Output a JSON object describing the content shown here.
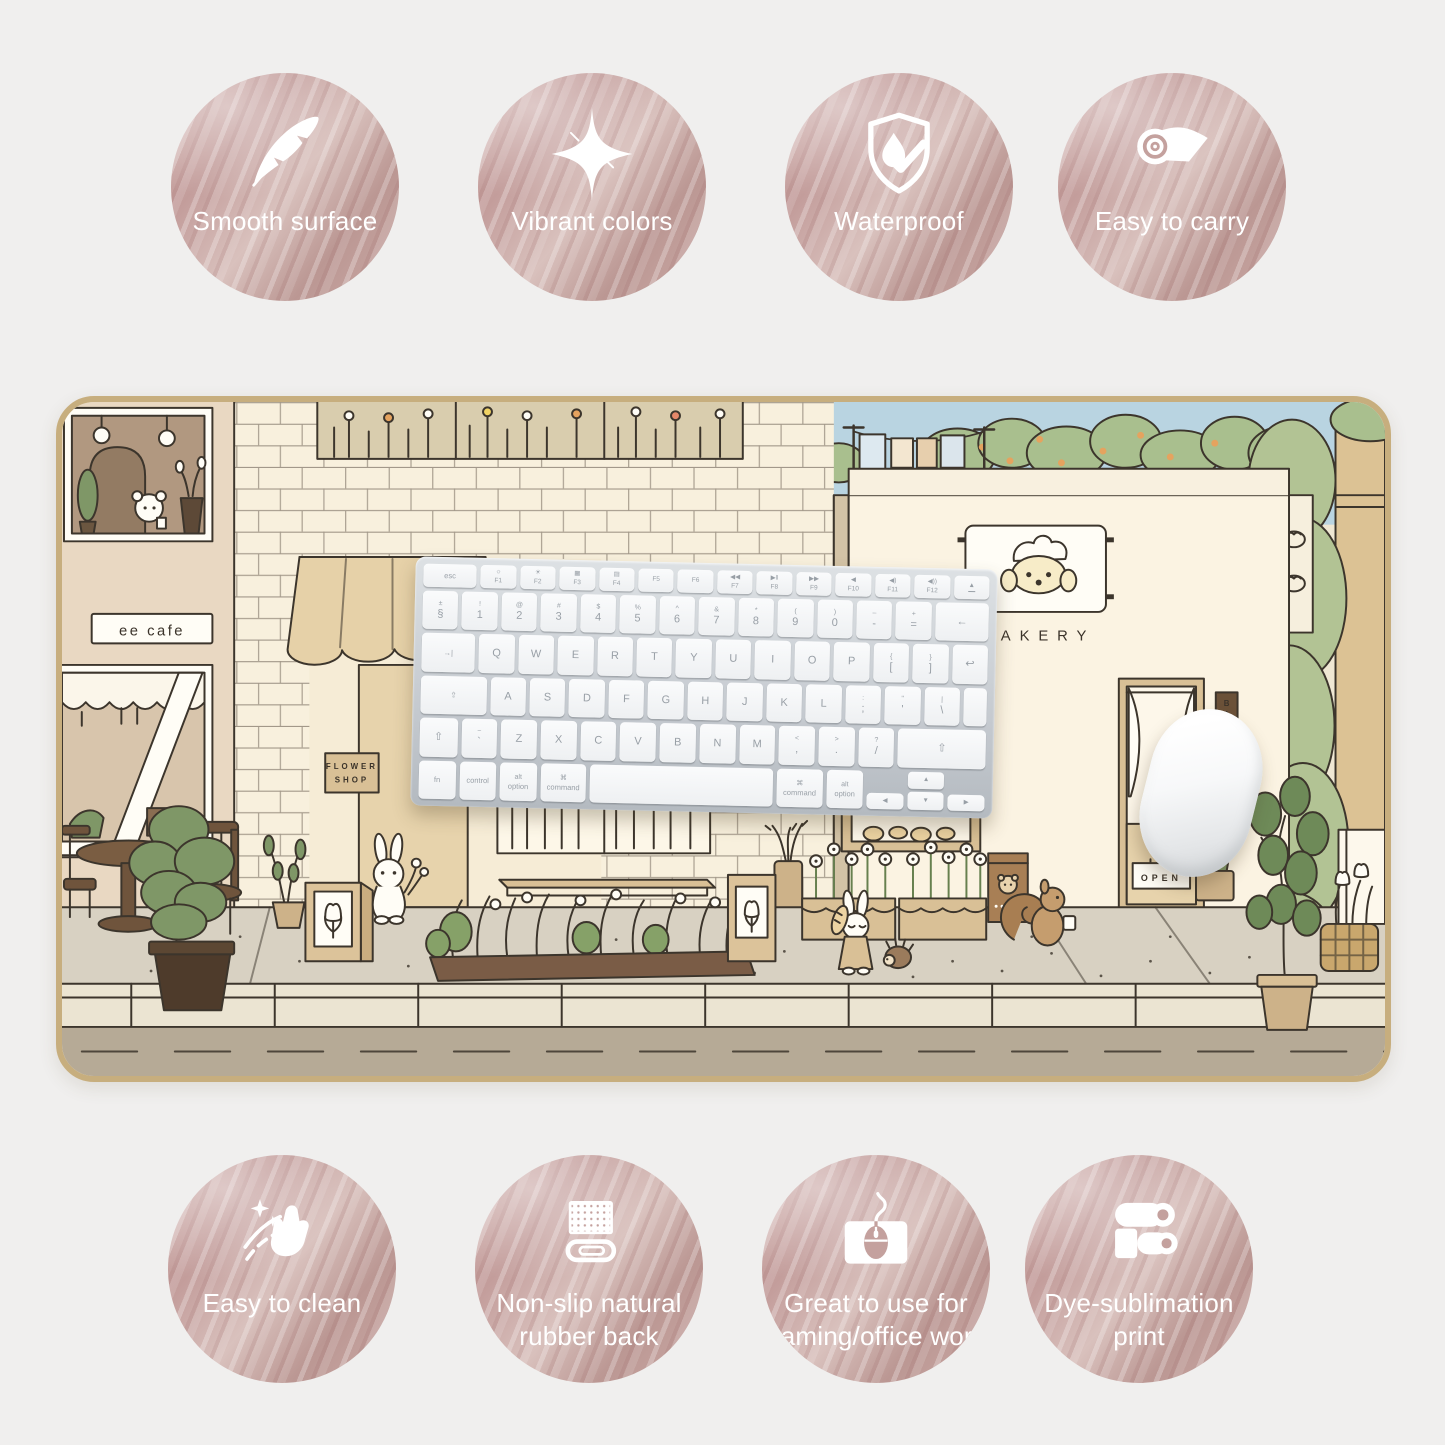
{
  "page": {
    "background": "#f0efee",
    "badge_pink": "#c4a19e",
    "badge_text_color": "#ffffff"
  },
  "badges": {
    "top": [
      {
        "label": "Smooth surface",
        "icon": "feather-icon"
      },
      {
        "label": "Vibrant colors",
        "icon": "sparkle-icon"
      },
      {
        "label": "Waterproof",
        "icon": "waterproof-shield-icon"
      },
      {
        "label": "Easy to carry",
        "icon": "rolled-mat-icon"
      }
    ],
    "bottom": [
      {
        "label": "Easy to clean",
        "icon": "cleaning-hand-icon"
      },
      {
        "label": "Non-slip natural\nrubber back",
        "icon": "rubber-back-icon"
      },
      {
        "label": "Great to use for\ngaming/office work",
        "icon": "computer-mouse-icon"
      },
      {
        "label": "Dye-sublimation\nprint",
        "icon": "print-rollers-icon"
      }
    ]
  },
  "mat": {
    "cafe_sign": "ee cafe",
    "flower_shop_sign": [
      "FLOWER",
      "SHOP"
    ],
    "bakery_sign": "BAKERY",
    "open_sign": "OPEN",
    "door_side_sign": "BAKERY"
  },
  "keyboard": {
    "rows": [
      {
        "cls": "frow",
        "keys": [
          {
            "b": "esc",
            "w": 1.5,
            "cls": "fkey word",
            "id": "esc"
          },
          {
            "t": "☼",
            "b": "F1",
            "cls": "fkey"
          },
          {
            "t": "☀",
            "b": "F2",
            "cls": "fkey"
          },
          {
            "t": "▦",
            "b": "F3",
            "cls": "fkey"
          },
          {
            "t": "▤",
            "b": "F4",
            "cls": "fkey"
          },
          {
            "b": "F5",
            "cls": "fkey"
          },
          {
            "b": "F6",
            "cls": "fkey"
          },
          {
            "t": "◀◀",
            "b": "F7",
            "cls": "fkey"
          },
          {
            "t": "▶‖",
            "b": "F8",
            "cls": "fkey"
          },
          {
            "t": "▶▶",
            "b": "F9",
            "cls": "fkey"
          },
          {
            "t": "◀",
            "b": "F10",
            "cls": "fkey"
          },
          {
            "t": "◀)",
            "b": "F11",
            "cls": "fkey"
          },
          {
            "t": "◀))",
            "b": "F12",
            "cls": "fkey"
          },
          {
            "b": "▲",
            "cls": "fkey eject",
            "id": "eject"
          }
        ]
      },
      {
        "keys": [
          {
            "t": "±",
            "b": "§"
          },
          {
            "t": "!",
            "b": "1"
          },
          {
            "t": "@",
            "b": "2"
          },
          {
            "t": "#",
            "b": "3"
          },
          {
            "t": "$",
            "b": "4"
          },
          {
            "t": "%",
            "b": "5"
          },
          {
            "t": "^",
            "b": "6"
          },
          {
            "t": "&",
            "b": "7"
          },
          {
            "t": "*",
            "b": "8"
          },
          {
            "t": "(",
            "b": "9"
          },
          {
            "t": ")",
            "b": "0"
          },
          {
            "t": "–",
            "b": "-"
          },
          {
            "t": "+",
            "b": "="
          },
          {
            "b": "←",
            "w": 1.5,
            "id": "delete"
          }
        ]
      },
      {
        "keys": [
          {
            "b": "→|",
            "w": 1.5,
            "cls": "word",
            "id": "tab"
          },
          {
            "b": "Q"
          },
          {
            "b": "W"
          },
          {
            "b": "E"
          },
          {
            "b": "R"
          },
          {
            "b": "T"
          },
          {
            "b": "Y"
          },
          {
            "b": "U"
          },
          {
            "b": "I"
          },
          {
            "b": "O"
          },
          {
            "b": "P"
          },
          {
            "t": "{",
            "b": "["
          },
          {
            "t": "}",
            "b": "]"
          },
          {
            "b": "↩",
            "id": "return"
          }
        ]
      },
      {
        "keys": [
          {
            "b": "⇪",
            "w": 1.85,
            "cls": "word",
            "id": "capslock"
          },
          {
            "b": "A"
          },
          {
            "b": "S"
          },
          {
            "b": "D"
          },
          {
            "b": "F"
          },
          {
            "b": "G"
          },
          {
            "b": "H"
          },
          {
            "b": "J"
          },
          {
            "b": "K"
          },
          {
            "b": "L"
          },
          {
            "t": ":",
            "b": ";"
          },
          {
            "t": "\"",
            "b": "'"
          },
          {
            "t": "|",
            "b": "\\"
          },
          {
            "b": "",
            "w": 0.65,
            "id": "return-lower"
          }
        ]
      },
      {
        "keys": [
          {
            "b": "⇧",
            "w": 1.05,
            "id": "shift-left"
          },
          {
            "t": "~",
            "b": "`"
          },
          {
            "b": "Z"
          },
          {
            "b": "X"
          },
          {
            "b": "C"
          },
          {
            "b": "V"
          },
          {
            "b": "B"
          },
          {
            "b": "N"
          },
          {
            "b": "M"
          },
          {
            "t": "<",
            "b": ","
          },
          {
            "t": ">",
            "b": "."
          },
          {
            "t": "?",
            "b": "/"
          },
          {
            "b": "⇧",
            "w": 2.45,
            "id": "shift-right"
          }
        ]
      },
      {
        "keys": [
          {
            "b": "fn",
            "cls": "word"
          },
          {
            "b": "control",
            "cls": "word"
          },
          {
            "t": "alt",
            "b": "option",
            "cls": "word",
            "id": "option-left"
          },
          {
            "t": "⌘",
            "b": "command",
            "w": 1.25,
            "cls": "word",
            "id": "command-left"
          },
          {
            "b": "",
            "w": 5,
            "id": "space"
          },
          {
            "t": "⌘",
            "b": "command",
            "w": 1.25,
            "cls": "word",
            "id": "command-right"
          },
          {
            "t": "alt",
            "b": "option",
            "cls": "word",
            "id": "option-right"
          },
          {
            "b": "◀",
            "cls": "arr",
            "id": "arrow-left"
          },
          {
            "t": "▲",
            "b": "▼",
            "ud": true,
            "id": "arrow-up-down"
          },
          {
            "b": "▶",
            "cls": "arr",
            "id": "arrow-right"
          }
        ]
      }
    ]
  }
}
